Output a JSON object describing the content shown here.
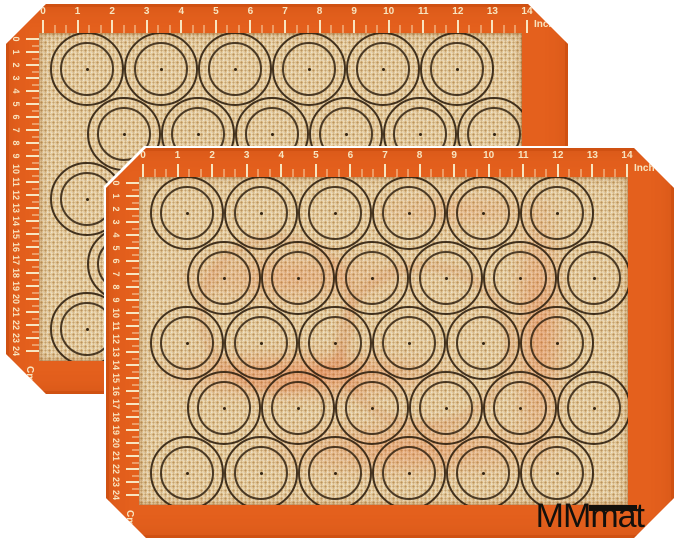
{
  "product": {
    "brand_logo": "MMmat"
  },
  "rulers": {
    "top": {
      "numbers": [
        "0",
        "1",
        "2",
        "3",
        "4",
        "5",
        "6",
        "7",
        "8",
        "9",
        "10",
        "11",
        "12",
        "13",
        "14"
      ],
      "unit": "Inch"
    },
    "left": {
      "numbers": [
        "0",
        "1",
        "2",
        "3",
        "4",
        "5",
        "6",
        "7",
        "8",
        "9",
        "10",
        "11",
        "12",
        "13",
        "14",
        "15",
        "16",
        "17",
        "18",
        "19",
        "20",
        "21",
        "22",
        "23",
        "24"
      ],
      "unit": "Cm"
    }
  },
  "grid": {
    "rows": 5,
    "circles_per_row": 6,
    "total_circles_per_mat": 30,
    "mat_count": 2
  },
  "colors": {
    "mat_orange": "#E4601D",
    "mesh_beige": "#EBCE9C",
    "ruler_cream": "#F8E5C0",
    "circle_ink": "#2B1C0C",
    "logo_black": "#13100C"
  }
}
